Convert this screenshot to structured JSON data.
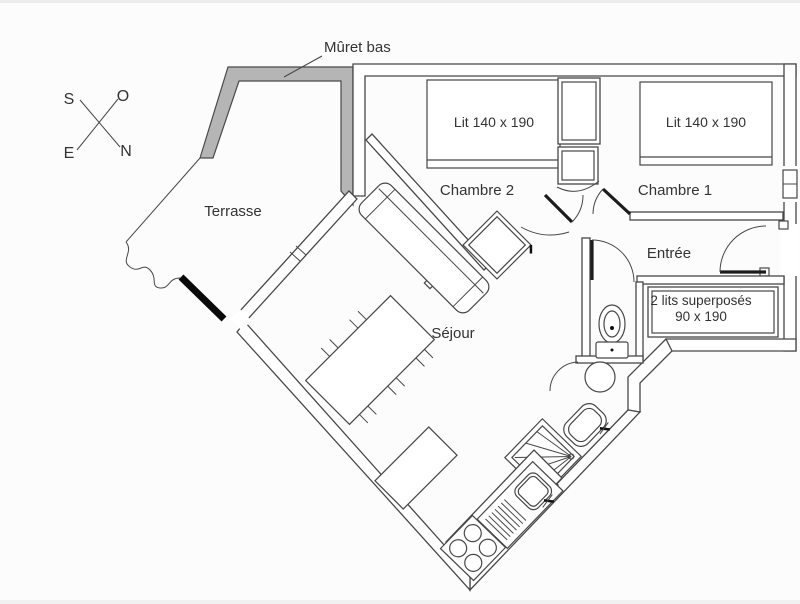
{
  "compass": {
    "top_left": "S",
    "top_right": "O",
    "bottom_left": "E",
    "bottom_right": "N"
  },
  "annotations": {
    "low_wall_label": "Mûret bas"
  },
  "rooms": {
    "terrace": {
      "label": "Terrasse"
    },
    "bedroom2": {
      "label": "Chambre 2",
      "bed_label": "Lit 140 x 190"
    },
    "bedroom1": {
      "label": "Chambre 1",
      "bed_label": "Lit 140 x 190"
    },
    "entry": {
      "label": "Entrée"
    },
    "bunk_alcove": {
      "label_line1": "2 lits superposés",
      "label_line2": "90 x 190"
    },
    "living": {
      "label": "Séjour"
    }
  },
  "colors": {
    "wall": "#474747",
    "solid_wall": "#0a0a0a",
    "low_wall_fill": "#b5b5b5",
    "background": "#fcfcfc",
    "text": "#333333"
  }
}
